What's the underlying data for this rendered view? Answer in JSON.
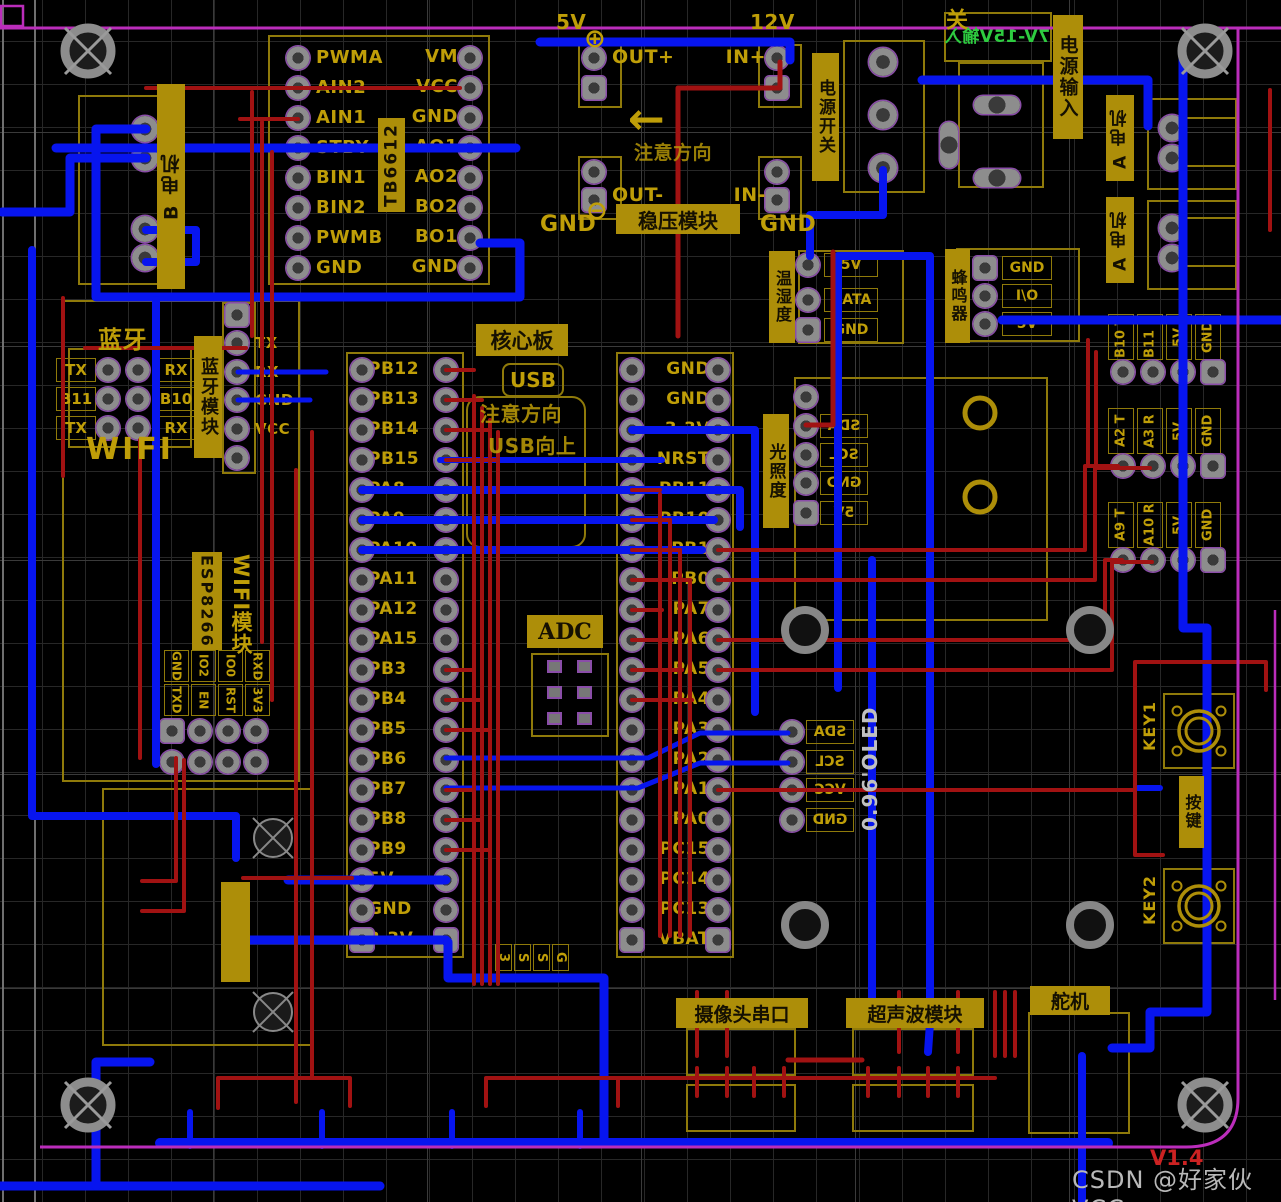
{
  "app": {
    "watermark": "CSDN @好家伙VCC",
    "version": "V1.4"
  },
  "colors": {
    "trace_top": "#a11212",
    "trace_bottom": "#0715ef",
    "silk_gold": "#bf9e08",
    "board_outline": "#bb2dbb",
    "label_green": "#2ecc40"
  },
  "tb6612": {
    "tag": "TB6612",
    "left_pins": [
      "PWMA",
      "AIN2",
      "AIN1",
      "STBY",
      "BIN1",
      "BIN2",
      "PWMB",
      "GND"
    ],
    "right_pins": [
      "VM",
      "VCC",
      "GND",
      "AO1",
      "AO2",
      "BO2",
      "BO1",
      "GND"
    ]
  },
  "regulator": {
    "tag": "稳压模块",
    "note": "注意方向",
    "rail_left": "5V",
    "rail_right": "12V",
    "pins": {
      "out_plus": "OUT+",
      "in_plus": "IN+",
      "out_minus": "OUT-",
      "in_minus": "IN-",
      "gnd_left": "GND",
      "gnd_right": "GND"
    }
  },
  "power": {
    "input_range": "7V-15V输入",
    "input_tag": "电源输入",
    "switch_tag": "电源开关",
    "switch_char": "关"
  },
  "motors": {
    "a_tag": "A 电机",
    "b_tag": "B 电机"
  },
  "bluetooth": {
    "title": "蓝牙",
    "wifi": "WIFI",
    "tag": "蓝牙模块",
    "grid": [
      [
        "TX",
        "RX"
      ],
      [
        "B11",
        "B10"
      ],
      [
        "TX",
        "RX"
      ]
    ],
    "side_pins": [
      "TX",
      "RX",
      "GND",
      "VCC"
    ]
  },
  "esp8266": {
    "tag": "ESP8266",
    "module_label": "WIFI模块",
    "row1": [
      "GND",
      "IO2",
      "IO0",
      "RXD"
    ],
    "row2": [
      "TXD",
      "EN",
      "RST",
      "3V3"
    ]
  },
  "core": {
    "tag": "核心板",
    "usb": "USB",
    "note1": "注意方向",
    "note2": "USB向上",
    "adc": "ADC",
    "left_pins": [
      "PB12",
      "PB13",
      "PB14",
      "PB15",
      "PA8",
      "PA9",
      "PA10",
      "PA11",
      "PA12",
      "PA15",
      "PB3",
      "PB4",
      "PB5",
      "PB6",
      "PB7",
      "PB8",
      "PB9",
      "5V",
      "GND",
      "3.3V"
    ],
    "right_pins": [
      "GND",
      "GND",
      "3.3V",
      "NRST",
      "PB11",
      "PB10",
      "PB1",
      "PB0",
      "PA7",
      "PA6",
      "PA5",
      "PA4",
      "PA3",
      "PA2",
      "PA1",
      "PA0",
      "PC15",
      "PC14",
      "PC13",
      "VBAT"
    ],
    "swd": [
      "3",
      "S",
      "S",
      "G"
    ]
  },
  "sensors": {
    "temp_humidity": {
      "tag": "温湿度",
      "pins": [
        "5V",
        "DATA",
        "GND"
      ]
    },
    "buzzer": {
      "tag": "蜂鸣器",
      "pins": [
        "GND",
        "I\\O",
        "5V"
      ]
    },
    "light": {
      "tag": "光照度",
      "pins": [
        "SDA",
        "SCL",
        "GND",
        "5V"
      ]
    }
  },
  "oled": {
    "label": "0.96'OLED",
    "pins": [
      "SDA",
      "SCL",
      "VCC",
      "GND"
    ]
  },
  "keys": {
    "key1": "KEY1",
    "key2": "KEY2",
    "tag": "按键"
  },
  "uart_headers": [
    {
      "pins": [
        "B10 T",
        "B11 R",
        "5V",
        "GND"
      ]
    },
    {
      "pins": [
        "A2 T",
        "A3 R",
        "5V",
        "GND"
      ]
    },
    {
      "pins": [
        "A9 T",
        "A10 R",
        "5V",
        "GND"
      ]
    }
  ],
  "ir_sensors": [
    {
      "num": "1",
      "tag": "红外对管",
      "pins": [
        "3.3",
        "G",
        "OUT"
      ]
    },
    {
      "num": "2",
      "tag": "红外对管",
      "pins": [
        "5V",
        "G",
        "OUT"
      ]
    },
    {
      "num": "3",
      "tag": "红外对管",
      "pins": [
        "5V",
        "G",
        "OUT"
      ]
    },
    {
      "num": "4",
      "tag": "红外对管",
      "pins": [
        "5V",
        "G",
        "OUT"
      ]
    }
  ],
  "camera": {
    "tag": "摄像头串口",
    "pins": [
      "TX",
      "RX",
      "G",
      "5V"
    ]
  },
  "ultrasonic": {
    "tag": "超声波模块",
    "pins": [
      "5V",
      "A0",
      "A1",
      "G"
    ]
  },
  "servo": {
    "tag": "舵机",
    "pins": [
      "G",
      "5V",
      "A6"
    ]
  }
}
